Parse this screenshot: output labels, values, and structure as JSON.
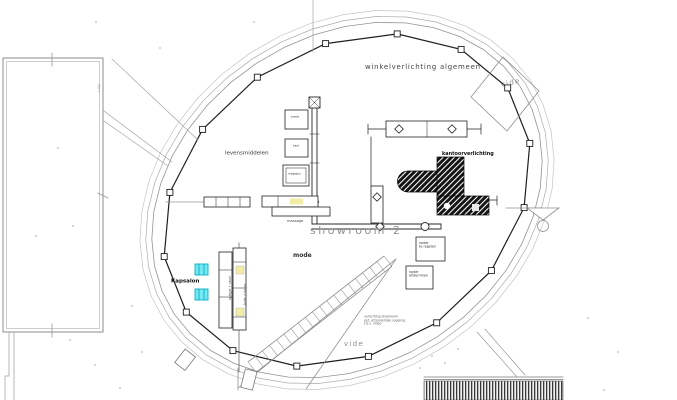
{
  "drawing": {
    "room_labels": {
      "lighting_general": "winkelverlichting algemeen",
      "office_lighting": "kantoorverlichting",
      "goods_area": "levensmiddelen",
      "showroom_title": "showroom  2",
      "mode": "mode",
      "massage": "massage",
      "kapsalon": "Kapsalon",
      "vide_lower": "vide",
      "vide_upper": "vide",
      "line_ref": "lijn c"
    },
    "fixture_boxes": {
      "box1": "prada",
      "box2": "kast",
      "box3": "magazijn"
    },
    "note_box_a": {
      "line1": "nader",
      "line2": "te regelen"
    },
    "note_box_b": {
      "line1": "nader",
      "line2": "afstemmen"
    },
    "stair_note": {
      "line1": "verlichting showroom",
      "line2": "det. afzonderlijke regeling",
      "line3": "t.b.v. video"
    },
    "counter_labels": {
      "left": "spiegel + stoel",
      "right": "balie + kassa"
    },
    "colors": {
      "line_dark": "#1f1f1f",
      "line_gray": "#9aa0a3",
      "highlight_cyan": "#74e9f3",
      "highlight_yellow": "#f2eda6"
    }
  }
}
